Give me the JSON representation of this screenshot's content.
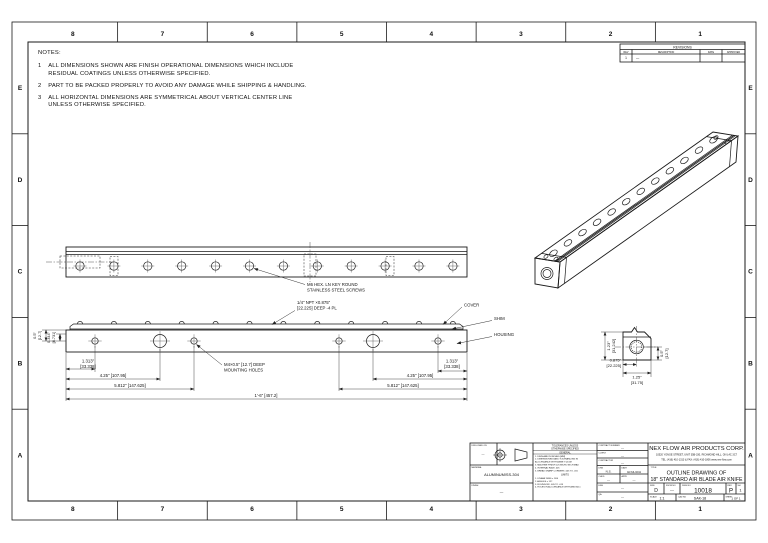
{
  "sheet": {
    "zone_columns": [
      "8",
      "7",
      "6",
      "5",
      "4",
      "3",
      "2",
      "1"
    ],
    "zone_rows": [
      "E",
      "D",
      "C",
      "B",
      "A"
    ]
  },
  "notes": {
    "title": "NOTES:",
    "items": [
      {
        "num": "1",
        "text": "ALL DIMENSIONS SHOWN ARE FINISH OPERATIONAL DIMENSIONS WHICH INCLUDE\nRESIDUAL COATINGS UNLESS OTHERWISE SPECIFIED."
      },
      {
        "num": "2",
        "text": "PART TO BE PACKED PROPERLY TO AVOID ANY DAMAGE WHILE SHIPPING & HANDLING."
      },
      {
        "num": "3",
        "text": "ALL HORIZONTAL DIMENSIONS ARE SYMMETRICAL ABOUT VERTICAL CENTER LINE\nUNLESS OTHERWISE SPECIFIED."
      }
    ]
  },
  "revisions": {
    "title": "REVISIONS",
    "col_rev": "REV",
    "col_description": "DESCRIPTION",
    "col_date": "DATE",
    "col_approved": "APPROVED",
    "row": {
      "rev": "1",
      "description": "—",
      "date": "",
      "approved": ""
    }
  },
  "views": {
    "dims": {
      "d1313_in": "1.313\"",
      "d1313_mm": "[33.338]",
      "d425": "4.25\" [107.95]",
      "d5812": "5.812\" [147.625]",
      "overall": "1'-6\" [457.2]",
      "v05_in": "0.5\"",
      "v05_mm": "[12.7]",
      "v0344_in": "0.344\"",
      "v0344_mm": "[8.731]",
      "end_height_in": "1.23\"",
      "end_height_mm": "[31.242]",
      "end_width_in": "1.25\"",
      "end_width_mm": "[31.75]",
      "end_port_in": "0.875\"",
      "end_port_mm": "[22.225]",
      "end_r_in": "0.5\"",
      "end_r_mm": "[12.7]"
    },
    "callouts": {
      "screws_1": "M6 HEX. LN KEY ROUND",
      "screws_2": "STAINLESS STEEL SCREWS",
      "npt_1": "1/4\" NPT ×0.875\"",
      "npt_2": "[22.225] DEEP -4 PL",
      "mount_1": "M4×0.5\" [12.7] DEEP",
      "mount_2": "MOUNTING HOLES",
      "cover": "COVER",
      "shim": "SHIM",
      "housing": "HOUSING"
    }
  },
  "title_block": {
    "company": {
      "name": "NEX FLOW AIR PRODUCTS CORP.",
      "address": "10520 YONGE STREET, UNIT 35B-330, RICHMOND HILL, ON L4C 3C7",
      "contact": "TEL: (416) 410-1313 & FAX: (416) 410-1806  www.nex-flow.com"
    },
    "title_label": "TITLE",
    "title_1": "OUTLINE DRAWING OF",
    "title_2": "18\" STANDARD AIR BLADE AIR KNIFE",
    "contract_label": "CONTRACT NUMBER",
    "contract_value": "—",
    "client_label": "CLIENT",
    "client_value": "—",
    "contractor_label": "CONTRACTOR",
    "contractor_value": "—",
    "drawn_label": "DRN",
    "drawn_value": "N.S.",
    "date_label": "DATE",
    "date_value": "02/JUL/2011",
    "checked_label": "CHKD",
    "checked_value": "—",
    "approved_label": "APPD",
    "approved_value": "—",
    "eng_label": "ENG",
    "eng_value": "—",
    "qa_label": "QA",
    "qa_value": "—",
    "used_on_label": "DWG USED ON",
    "used_on_value": "—",
    "material_label": "MATERIAL",
    "material_value": "ALUMINUM/SS-304",
    "finish_label": "FINISH",
    "finish_value": "—",
    "size_label": "SIZE",
    "size_value": "D",
    "fscm_label": "FSCM NO",
    "fscm_value": "—",
    "dwg_no_label": "DWG NO",
    "dwg_no_value": "10018",
    "rev_label": "REV",
    "rev_value": "P",
    "sh_label": "SH",
    "sh_value": "1",
    "scale_label": "SCALE",
    "scale_value": "1:1",
    "cad_label": "CAD NO",
    "cad_value": "SAK-18",
    "sheet_label": "SHEET",
    "sheet_value": "1 OF 1",
    "tolerances": {
      "header_1": "TOLERANCES UNLESS",
      "header_2": "OTHERWISE SPECIFIED",
      "general_title": "GENERAL",
      "general_items": [
        "1. DIMS ARE IN INCHES [MM]",
        "2. DIMENSIONING AND TOLERANCING IN",
        "    ACCORDANCE WITH ASME Y14.5M",
        "3. MACHINE FINISH 125 MICRO INCH MAX",
        "4. INTERNAL RADII .005",
        "5. BREAK SHARP CORNERS .005 TO .015"
      ],
      "limits_title": "LIMITS",
      "limits_items": [
        "1. LINEAR DIMS ± 1/64",
        "2. ANGLES ± 1/2°",
        "3. ROUNDOFF .005 TO .015",
        "4. HOLES IN ACCORDANCE WITH ANSI B4.1"
      ]
    }
  }
}
